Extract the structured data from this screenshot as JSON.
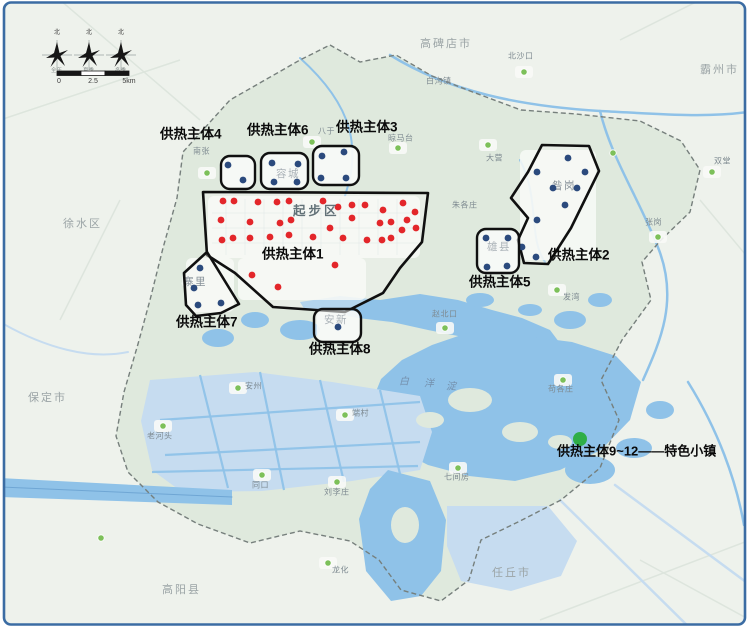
{
  "colors": {
    "frame": "#3b6ca3",
    "land_out": "#eef2ec",
    "land_in": "#dfe9dd",
    "water": "#8fc2e8",
    "water_light": "#c6dcf0",
    "urban": "#f8faf7",
    "grid": "#cfd9dd",
    "boundary": "#767f7c",
    "zone_outline": "#101010",
    "red_dot": "#e3262a",
    "blue_dot": "#2b4a7d",
    "town_dot": "#7dc05a",
    "legend_dot": "#2fae47",
    "city_label": "#9ba4a6",
    "town_label": "#7e8a91",
    "inner_label": "#4a5a68",
    "lake_label": "#7490ad",
    "district_label": "#54646b"
  },
  "compass": {
    "y": 55,
    "roses": [
      {
        "x": 57,
        "north": "北",
        "label": "全年"
      },
      {
        "x": 89,
        "north": "北",
        "label": "夏季"
      },
      {
        "x": 121,
        "north": "北",
        "label": "冬季"
      }
    ]
  },
  "scalebar": {
    "x": 57,
    "y": 71,
    "seg": 24,
    "ticks": [
      "0",
      "2.5",
      "5km"
    ]
  },
  "legend": {
    "dot": [
      580,
      439
    ],
    "dot_r": 7,
    "text": "供热主体9~12——特色小镇",
    "x": 557,
    "y": 446
  },
  "district_label": {
    "text": "起步区",
    "x": 293,
    "y": 206
  },
  "lake_label": {
    "chars": [
      "白",
      "洋",
      "淀"
    ],
    "positions": [
      [
        399,
        378
      ],
      [
        424,
        380
      ],
      [
        446,
        383
      ]
    ]
  },
  "cities": [
    {
      "name": "高碑店市",
      "x": 420,
      "y": 40
    },
    {
      "name": "霸州市",
      "x": 700,
      "y": 66
    },
    {
      "name": "徐水区",
      "x": 63,
      "y": 220
    },
    {
      "name": "保定市",
      "x": 28,
      "y": 394
    },
    {
      "name": "高阳县",
      "x": 162,
      "y": 586
    },
    {
      "name": "任丘市",
      "x": 492,
      "y": 569
    }
  ],
  "inner_towns": [
    {
      "name": "容城",
      "x": 276,
      "y": 170
    },
    {
      "name": "寨里",
      "x": 183,
      "y": 278
    },
    {
      "name": "安新",
      "x": 324,
      "y": 316
    },
    {
      "name": "雄县",
      "x": 487,
      "y": 243
    },
    {
      "name": "昝岗",
      "x": 552,
      "y": 182
    }
  ],
  "towns": [
    {
      "name": "八于",
      "dot": [
        312,
        142
      ],
      "lx": 318,
      "ly": 128
    },
    {
      "name": "南张",
      "dot": [
        207,
        173
      ],
      "lx": 193,
      "ly": 148
    },
    {
      "name": "晾马台",
      "dot": [
        398,
        148
      ],
      "lx": 388,
      "ly": 135
    },
    {
      "name": "北沙口",
      "dot": [
        524,
        72
      ],
      "lx": 508,
      "ly": 53
    },
    {
      "name": "白沟镇",
      "dot": null,
      "lx": 426,
      "ly": 78
    },
    {
      "name": "大营",
      "dot": [
        488,
        145
      ],
      "lx": 486,
      "ly": 155
    },
    {
      "name": "双堂",
      "dot": [
        712,
        172
      ],
      "lx": 714,
      "ly": 158
    },
    {
      "name": "张岗",
      "dot": [
        658,
        237
      ],
      "lx": 645,
      "ly": 219
    },
    {
      "name": "朱各庄",
      "dot": null,
      "lx": 452,
      "ly": 202
    },
    {
      "name": "发湾",
      "dot": [
        557,
        290
      ],
      "lx": 563,
      "ly": 294
    },
    {
      "name": "赵北口",
      "dot": [
        445,
        328
      ],
      "lx": 432,
      "ly": 311
    },
    {
      "name": "端村",
      "dot": [
        345,
        415
      ],
      "lx": 352,
      "ly": 410
    },
    {
      "name": "安州",
      "dot": [
        238,
        388
      ],
      "lx": 245,
      "ly": 383
    },
    {
      "name": "老河头",
      "dot": [
        163,
        426
      ],
      "lx": 147,
      "ly": 433
    },
    {
      "name": "同口",
      "dot": [
        262,
        475
      ],
      "lx": 252,
      "ly": 482
    },
    {
      "name": "刘李庄",
      "dot": [
        337,
        482
      ],
      "lx": 324,
      "ly": 489
    },
    {
      "name": "七间房",
      "dot": [
        458,
        468
      ],
      "lx": 444,
      "ly": 474
    },
    {
      "name": "苟各庄",
      "dot": [
        563,
        380
      ],
      "lx": 548,
      "ly": 386
    },
    {
      "name": "龙化",
      "dot": [
        328,
        563
      ],
      "lx": 332,
      "ly": 567
    }
  ],
  "extra_green_dots": [
    [
      101,
      538
    ],
    [
      613,
      153
    ]
  ],
  "zones": [
    {
      "id": "zone1",
      "label": "供热主体1",
      "label_x": 262,
      "label_y": 249,
      "shape": "polygon",
      "points": "203,192 428,193 422,242 400,268 383,293 345,312 273,307 235,273 207,255",
      "dot_color": "red",
      "dots": [
        [
          223,
          201
        ],
        [
          234,
          201
        ],
        [
          258,
          202
        ],
        [
          277,
          202
        ],
        [
          289,
          201
        ],
        [
          323,
          201
        ],
        [
          338,
          207
        ],
        [
          352,
          205
        ],
        [
          365,
          205
        ],
        [
          383,
          210
        ],
        [
          403,
          203
        ],
        [
          415,
          212
        ],
        [
          221,
          220
        ],
        [
          250,
          222
        ],
        [
          280,
          223
        ],
        [
          291,
          220
        ],
        [
          330,
          228
        ],
        [
          352,
          218
        ],
        [
          380,
          223
        ],
        [
          391,
          222
        ],
        [
          407,
          220
        ],
        [
          416,
          228
        ],
        [
          222,
          240
        ],
        [
          233,
          238
        ],
        [
          250,
          238
        ],
        [
          270,
          237
        ],
        [
          289,
          235
        ],
        [
          313,
          237
        ],
        [
          343,
          238
        ],
        [
          367,
          240
        ],
        [
          382,
          240
        ],
        [
          391,
          238
        ],
        [
          402,
          230
        ],
        [
          252,
          275
        ],
        [
          278,
          287
        ],
        [
          335,
          265
        ]
      ]
    },
    {
      "id": "zone2",
      "label": "供热主体2",
      "label_x": 548,
      "label_y": 250,
      "shape": "polygon",
      "points": "542,145 589,146 599,171 571,228 548,264 524,263 518,240 528,218 511,198 528,172",
      "dot_color": "blue",
      "dots": [
        [
          568,
          158
        ],
        [
          585,
          172
        ],
        [
          537,
          172
        ],
        [
          553,
          188
        ],
        [
          577,
          188
        ],
        [
          565,
          205
        ],
        [
          537,
          220
        ],
        [
          522,
          247
        ],
        [
          536,
          257
        ]
      ]
    },
    {
      "id": "zone3",
      "label": "供热主体3",
      "label_x": 336,
      "label_y": 122,
      "shape": "rect",
      "rect": [
        313,
        146,
        46,
        39
      ],
      "dot_color": "blue",
      "dots": [
        [
          322,
          156
        ],
        [
          344,
          152
        ],
        [
          321,
          178
        ],
        [
          346,
          178
        ]
      ]
    },
    {
      "id": "zone4",
      "label": "供热主体4",
      "label_x": 160,
      "label_y": 129,
      "shape": "rect",
      "rect": [
        221,
        156,
        34,
        33
      ],
      "dot_color": "blue",
      "dots": [
        [
          228,
          165
        ],
        [
          243,
          180
        ]
      ]
    },
    {
      "id": "zone5",
      "label": "供热主体5",
      "label_x": 469,
      "label_y": 277,
      "shape": "rect",
      "rect": [
        477,
        229,
        42,
        44
      ],
      "dot_color": "blue",
      "dots": [
        [
          486,
          238
        ],
        [
          508,
          238
        ],
        [
          487,
          267
        ],
        [
          507,
          266
        ]
      ]
    },
    {
      "id": "zone6",
      "label": "供热主体6",
      "label_x": 247,
      "label_y": 125,
      "shape": "rect",
      "rect": [
        261,
        153,
        47,
        36
      ],
      "dot_color": "blue",
      "dots": [
        [
          272,
          163
        ],
        [
          298,
          164
        ],
        [
          274,
          182
        ],
        [
          297,
          182
        ]
      ]
    },
    {
      "id": "zone7",
      "label": "供热主体7",
      "label_x": 176,
      "label_y": 317,
      "shape": "polygon",
      "points": "207,252 239,304 221,313 196,316 186,305 184,273",
      "dot_color": "blue",
      "dots": [
        [
          200,
          268
        ],
        [
          194,
          288
        ],
        [
          198,
          305
        ],
        [
          221,
          303
        ]
      ]
    },
    {
      "id": "zone8",
      "label": "供热主体8",
      "label_x": 309,
      "label_y": 344,
      "shape": "rect",
      "rect": [
        314,
        309,
        47,
        33
      ],
      "dot_color": "blue",
      "dots": [
        [
          338,
          327
        ]
      ]
    }
  ],
  "map_shapes": {
    "boundary": "330,45 360,62 396,55 432,76 470,91 521,110 576,114 640,121 681,141 700,170 690,212 661,240 642,262 651,300 622,340 601,380 619,420 600,468 561,500 520,521 481,540 469,580 441,601 401,590 379,560 350,541 300,531 250,543 198,524 158,502 128,472 116,436 124,392 138,344 150,300 163,248 177,198 183,152 230,100 300,60",
    "water_polys": [
      {
        "points": "300,302 340,296 380,300 420,294 458,300 492,310 522,318 550,330 562,346 540,354 505,346 468,338 428,330 392,322 358,318 328,312 305,310",
        "fill": "water"
      },
      {
        "points": "470,332 525,336 572,342 616,356 641,382 630,420 601,450 560,470 515,481 469,476 428,465 399,450 379,429 371,404 381,379 402,360 432,345",
        "fill": "water"
      },
      {
        "points": "150,380 255,372 332,382 420,396 432,432 420,470 352,481 262,491 182,492 152,470 141,421",
        "fill": "water_light"
      },
      {
        "points": "388,470 430,481 446,520 441,571 421,596 391,601 366,571 359,519 370,489",
        "fill": "water"
      },
      {
        "points": "447,506 548,506 577,541 561,576 511,591 461,581 447,546",
        "fill": "water_light"
      },
      {
        "points": "0,478 232,490 232,505 0,497",
        "fill": "water"
      }
    ],
    "water_blobs": [
      [
        590,
        470,
        25,
        14
      ],
      [
        634,
        448,
        18,
        10
      ],
      [
        660,
        410,
        14,
        9
      ],
      [
        300,
        330,
        20,
        10
      ],
      [
        255,
        320,
        14,
        8
      ],
      [
        218,
        338,
        16,
        9
      ],
      [
        570,
        320,
        16,
        9
      ],
      [
        600,
        300,
        12,
        7
      ],
      [
        480,
        300,
        14,
        7
      ],
      [
        530,
        310,
        12,
        6
      ]
    ],
    "islands": [
      [
        470,
        400,
        22,
        12
      ],
      [
        520,
        432,
        18,
        10
      ],
      [
        430,
        420,
        14,
        8
      ],
      [
        560,
        442,
        12,
        7
      ],
      [
        405,
        525,
        14,
        18
      ]
    ],
    "rivers": [
      {
        "d": "M390,55 C450,92 520,106 600,111 C660,114 705,118 748,112",
        "w": 2.5,
        "c": "water"
      },
      {
        "d": "M600,111 C612,160 640,200 659,250 C678,300 661,340 643,380",
        "w": 2.5,
        "c": "water"
      },
      {
        "d": "M300,58 C330,85 350,115 352,146 C354,170 348,185 345,196",
        "w": 2,
        "c": "water"
      },
      {
        "d": "M520,160 C540,198 528,238 545,262",
        "w": 2,
        "c": "water"
      },
      {
        "d": "M688,382 C718,430 736,480 744,525",
        "w": 2.5,
        "c": "water"
      },
      {
        "d": "M560,500 L700,638",
        "w": 2.5,
        "c": "water_light"
      },
      {
        "d": "M615,485 L750,585",
        "w": 2.5,
        "c": "water_light"
      },
      {
        "d": "M0,322 C45,348 90,360 128,352",
        "w": 2,
        "c": "water_light"
      },
      {
        "d": "M0,487 L232,497",
        "w": 1,
        "c": "#6fa6d4"
      }
    ],
    "channels": [
      "M160,420 L420,402",
      "M165,455 L420,442",
      "M152,472 L418,466",
      "M200,375 L228,488",
      "M260,372 L284,490",
      "M320,380 L344,482",
      "M380,390 L400,474"
    ],
    "roads": [
      "M0,120 L180,60",
      "M60,0 L200,120",
      "M640,560 L750,620",
      "M540,620 L750,540",
      "M120,200 L60,320",
      "M700,200 L750,260",
      "M620,40 L700,0"
    ],
    "urban_patches": [
      [
        208,
        196,
        212,
        62
      ],
      [
        238,
        258,
        128,
        42
      ],
      [
        222,
        157,
        32,
        30
      ],
      [
        263,
        154,
        43,
        33
      ],
      [
        315,
        148,
        43,
        36
      ],
      [
        480,
        231,
        37,
        40
      ],
      [
        317,
        311,
        42,
        29
      ],
      [
        186,
        258,
        48,
        54
      ],
      [
        520,
        150,
        76,
        110
      ]
    ]
  }
}
